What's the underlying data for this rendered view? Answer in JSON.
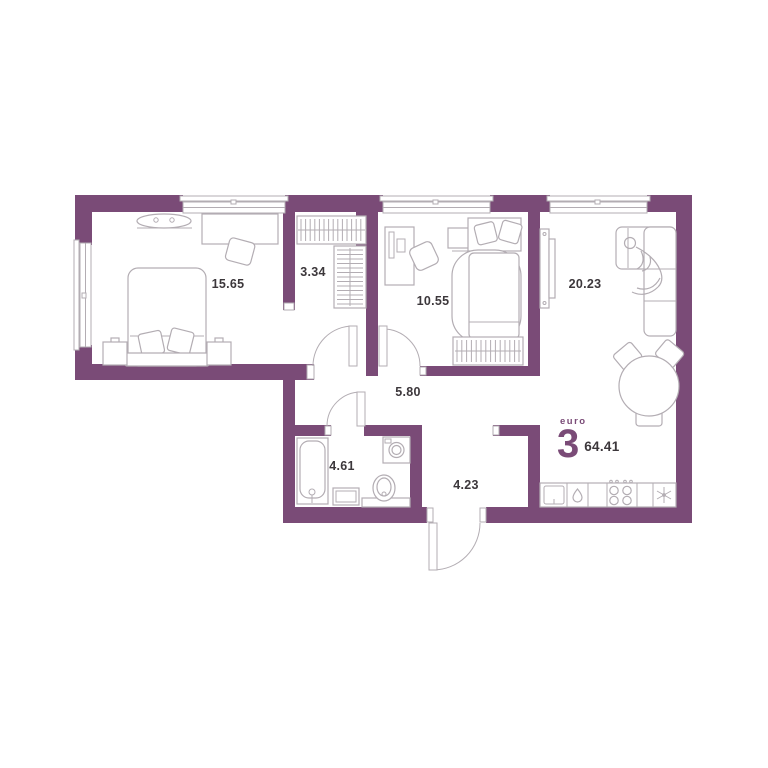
{
  "plan": {
    "colors": {
      "wall": "#7a4b77",
      "line": "#b3adb3",
      "ink": "#3c373b"
    },
    "rooms": [
      {
        "id": "bedroom-main",
        "area": "15.65"
      },
      {
        "id": "wardrobe",
        "area": "3.34"
      },
      {
        "id": "bedroom-second",
        "area": "10.55"
      },
      {
        "id": "living-kitchen",
        "area": "20.23"
      },
      {
        "id": "hallway",
        "area": "5.80"
      },
      {
        "id": "bathroom",
        "area": "4.61"
      },
      {
        "id": "corridor",
        "area": "4.23"
      }
    ],
    "furniture": [
      "double-bed",
      "nightstand",
      "desk",
      "office-chair",
      "ceiling-lamp",
      "hanger-rack",
      "single-bed",
      "tv-unit",
      "corner-sofa",
      "person",
      "round-table",
      "chair",
      "bathtub",
      "washing-machine",
      "sink",
      "vanity-cabinet",
      "kitchen-sink",
      "dishwasher-drop",
      "stove-4-burners",
      "fridge-snowflake"
    ]
  },
  "unit": {
    "type_label": "euro",
    "rooms_count": "3",
    "total_area": "64.41"
  }
}
